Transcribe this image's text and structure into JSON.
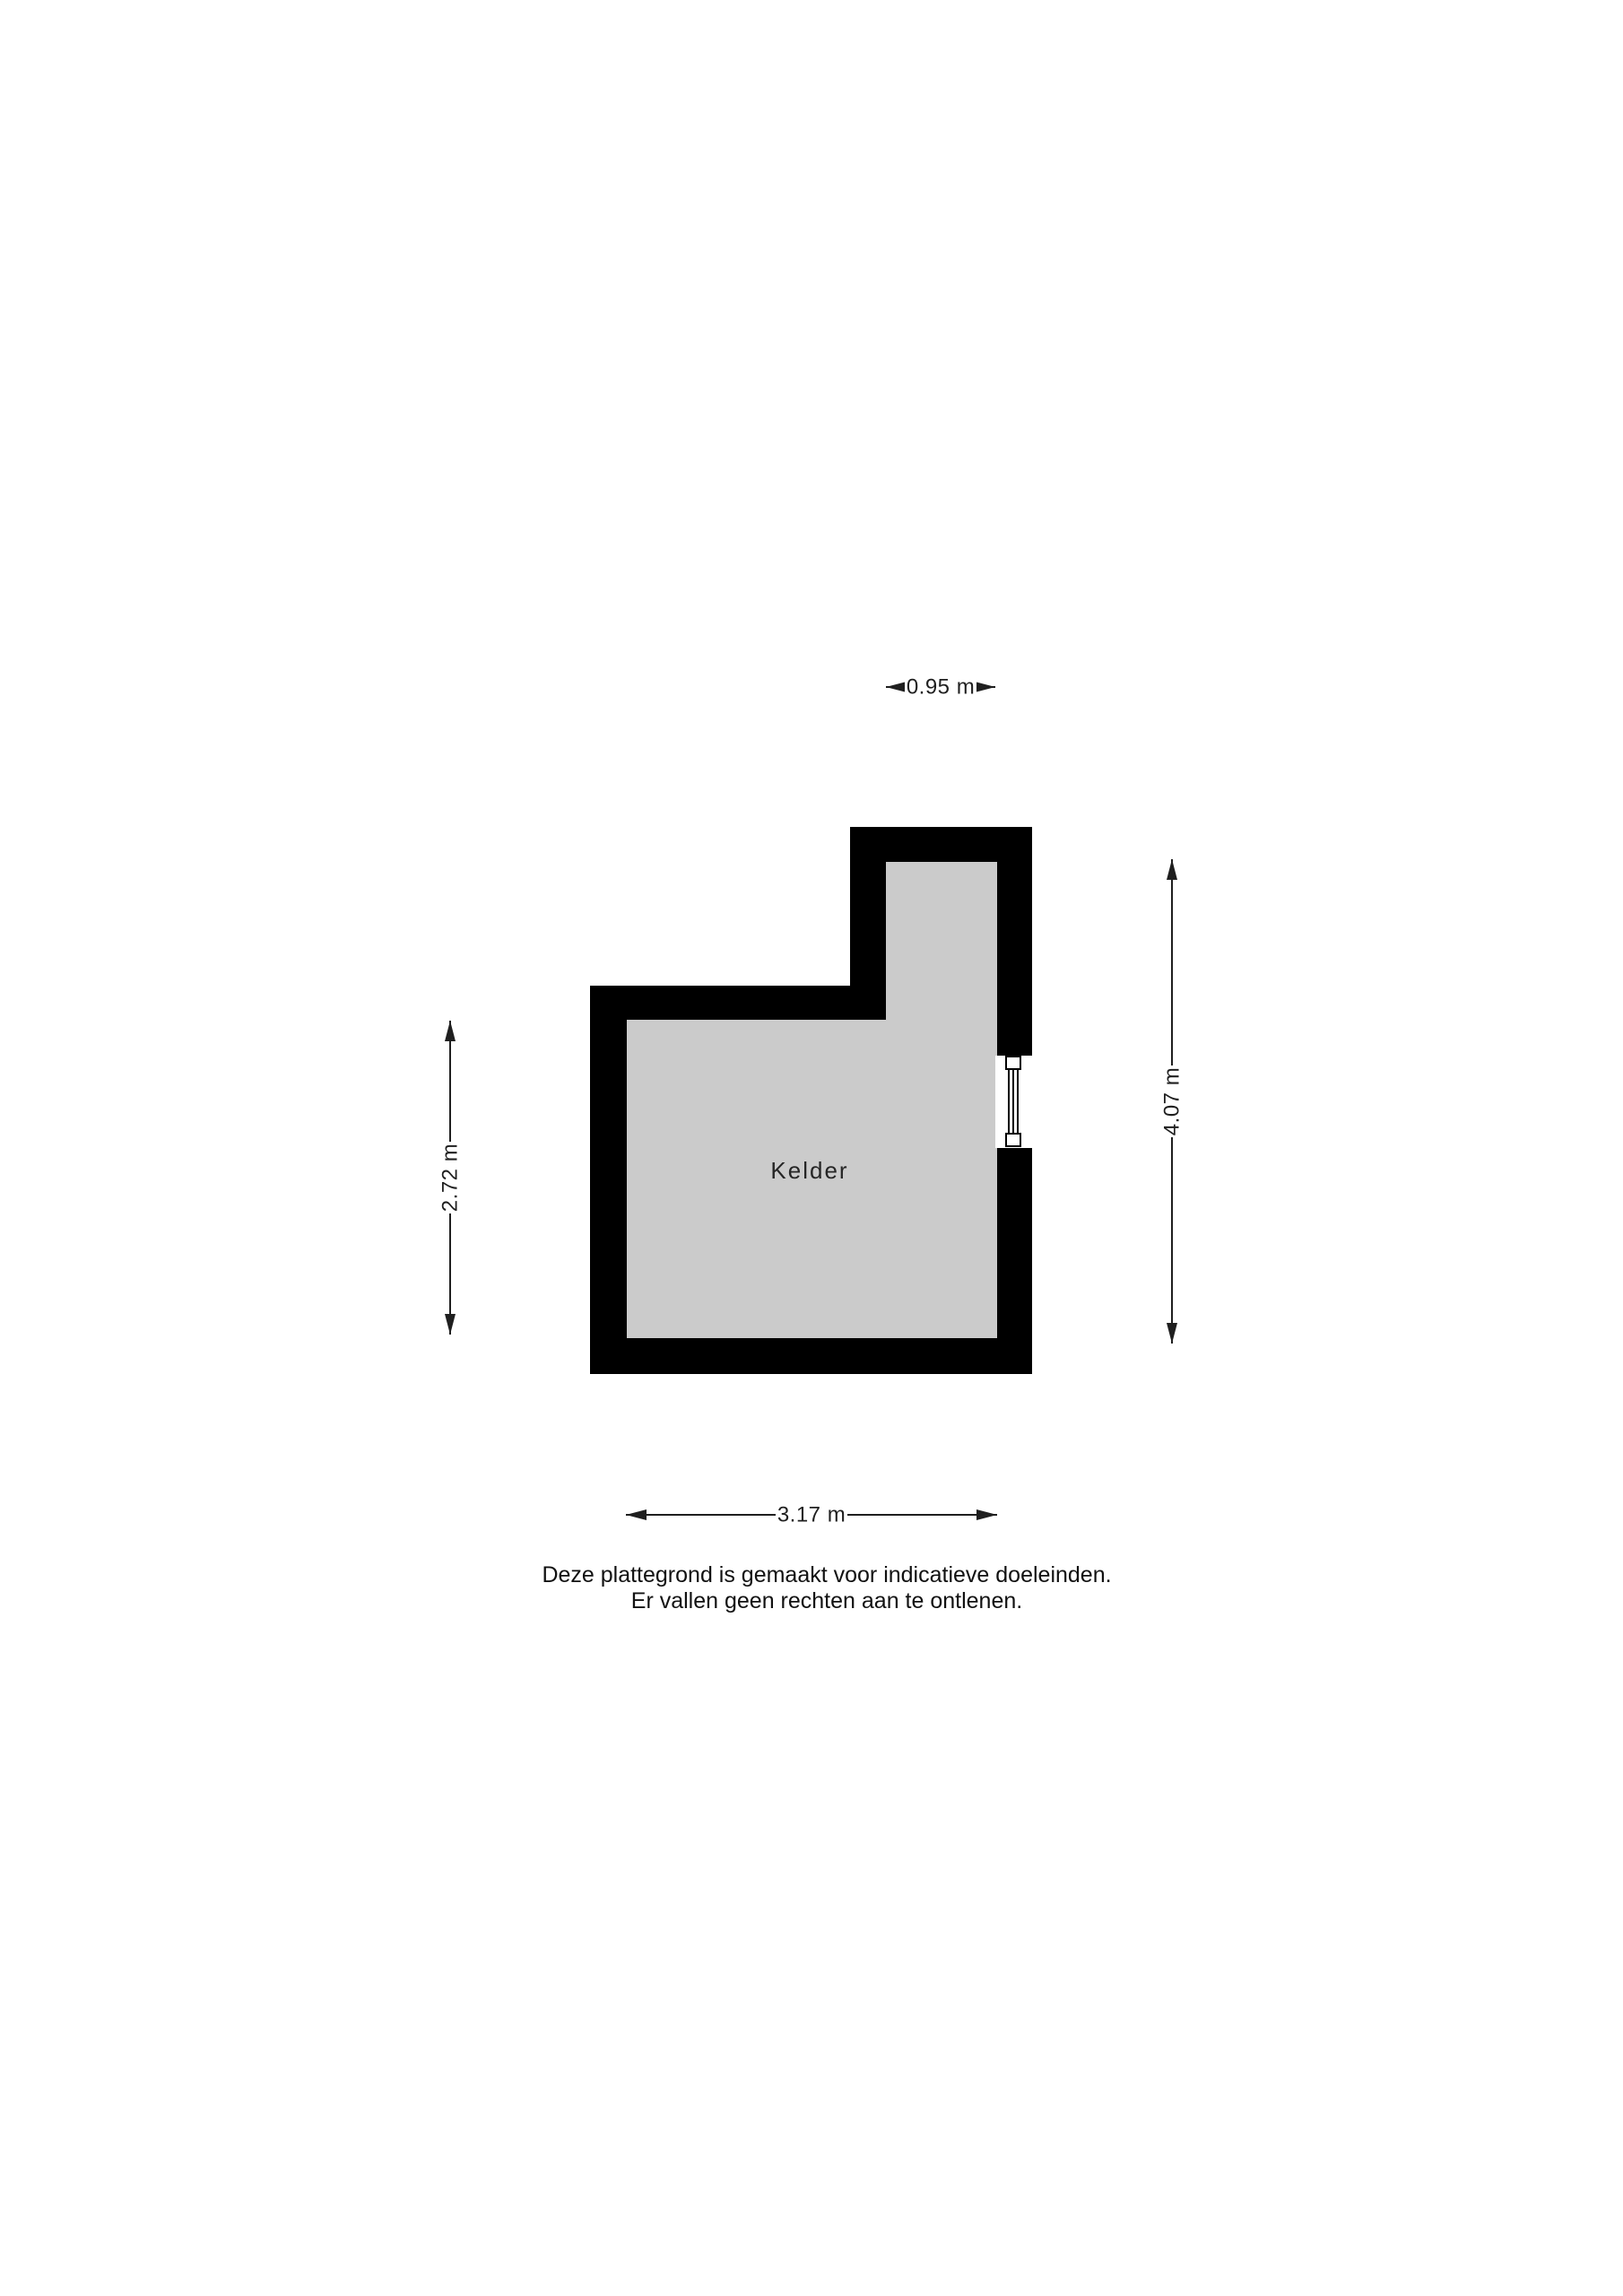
{
  "floor_plan": {
    "room": {
      "label": "Kelder"
    },
    "dimensions": {
      "top": {
        "label": "0.95 m"
      },
      "right": {
        "label": "4.07 m"
      },
      "left": {
        "label": "2.72 m"
      },
      "bottom": {
        "label": "3.17 m"
      }
    },
    "disclaimer": {
      "line1": "Deze plattegrond is gemaakt voor indicatieve doeleinden.",
      "line2": "Er vallen geen rechten aan te ontlenen."
    },
    "colors": {
      "wall": "#000000",
      "room_fill": "#cbcbcb",
      "background": "#ffffff",
      "line": "#1f1f1f"
    }
  }
}
